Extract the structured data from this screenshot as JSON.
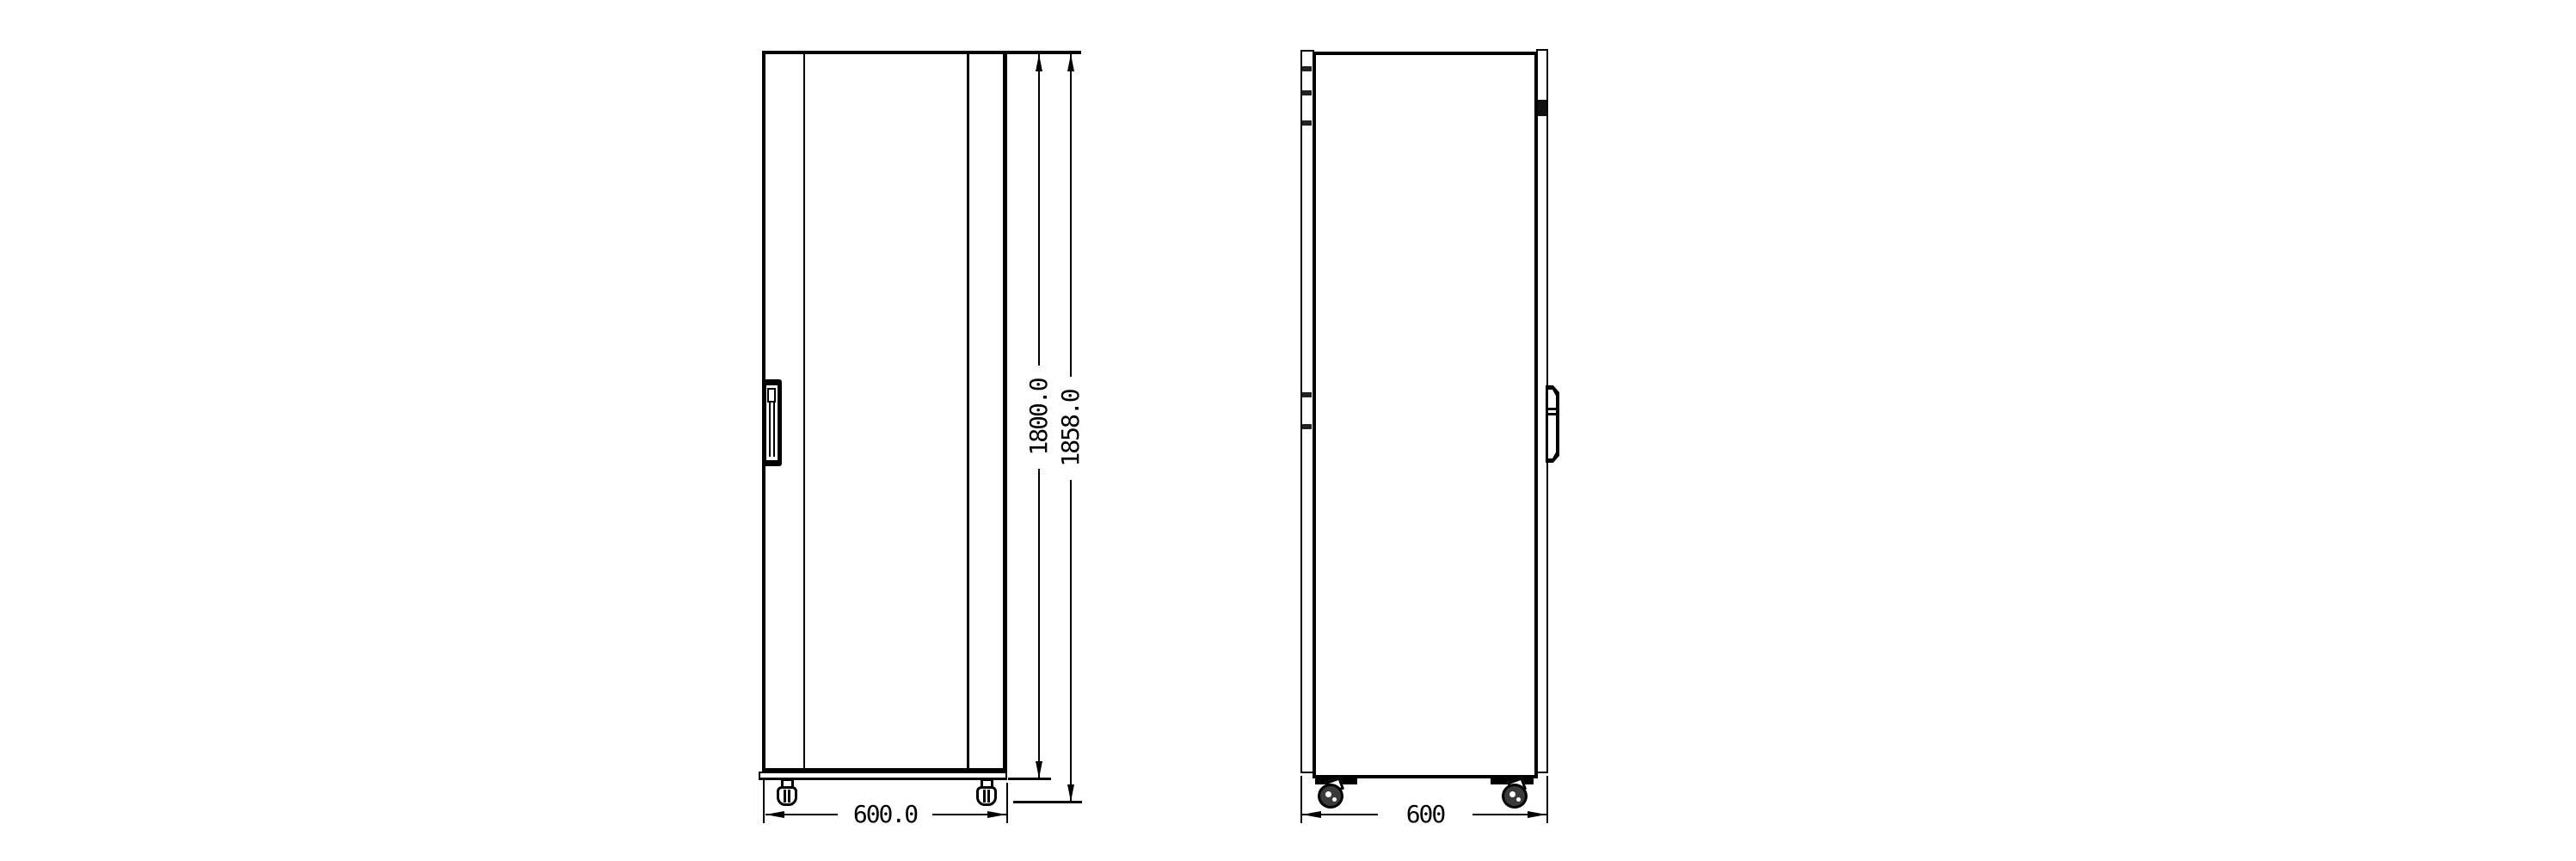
{
  "drawing": {
    "background": "#ffffff",
    "line_color": "#000000",
    "front_view": {
      "width_dim_label": "600.0",
      "height_dim_label": "1800.0",
      "overall_height_dim_label": "1858.0"
    },
    "side_view": {
      "depth_dim_label": "600"
    }
  }
}
